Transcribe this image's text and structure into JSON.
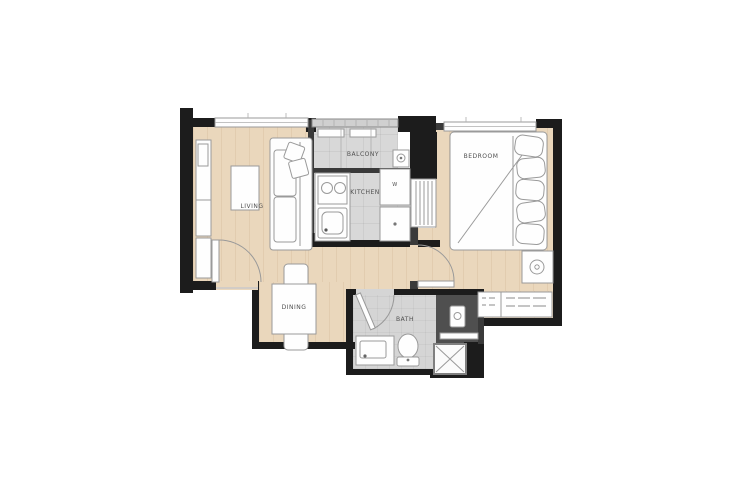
{
  "rooms": {
    "living": {
      "label": "LIVING"
    },
    "dining": {
      "label": "DINING"
    },
    "kitchen": {
      "label": "KITCHEN"
    },
    "balcony": {
      "label": "BALCONY"
    },
    "bedroom": {
      "label": "BEDROOM"
    },
    "bath": {
      "label": "BATH"
    }
  },
  "appliances": {
    "washer_label": "W"
  },
  "colors": {
    "background": "#ffffff",
    "wood_floor": "#ead7bc",
    "tile_floor": "#d8d8d8",
    "bath_floor": "#d5d5d5",
    "wall": "#1c1c1c",
    "wall_medium": "#3a3a3a",
    "utility_area": "#4f4f4f",
    "furniture_fill": "#fefefe",
    "furniture_stroke": "#9a9a9a",
    "label_text": "#4f4f4f"
  }
}
